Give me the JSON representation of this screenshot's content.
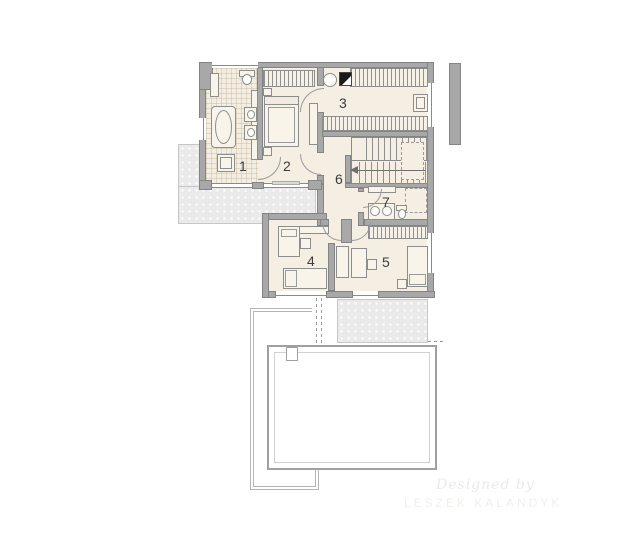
{
  "rooms": [
    {
      "number": "1"
    },
    {
      "number": "2"
    },
    {
      "number": "3"
    },
    {
      "number": "4"
    },
    {
      "number": "5"
    },
    {
      "number": "6"
    },
    {
      "number": "7"
    }
  ],
  "watermark": {
    "line1": "Designed by",
    "line2": "LESZEK KALANDYK"
  },
  "colors": {
    "wall": "#a8a8a8",
    "wall_outline": "#848484",
    "floor": "#f4eee3",
    "terrace": "#eaeaea",
    "label": "#3c3c3c",
    "dark_fixture": "#1a1a1a",
    "watermark": "#eaeae7"
  }
}
